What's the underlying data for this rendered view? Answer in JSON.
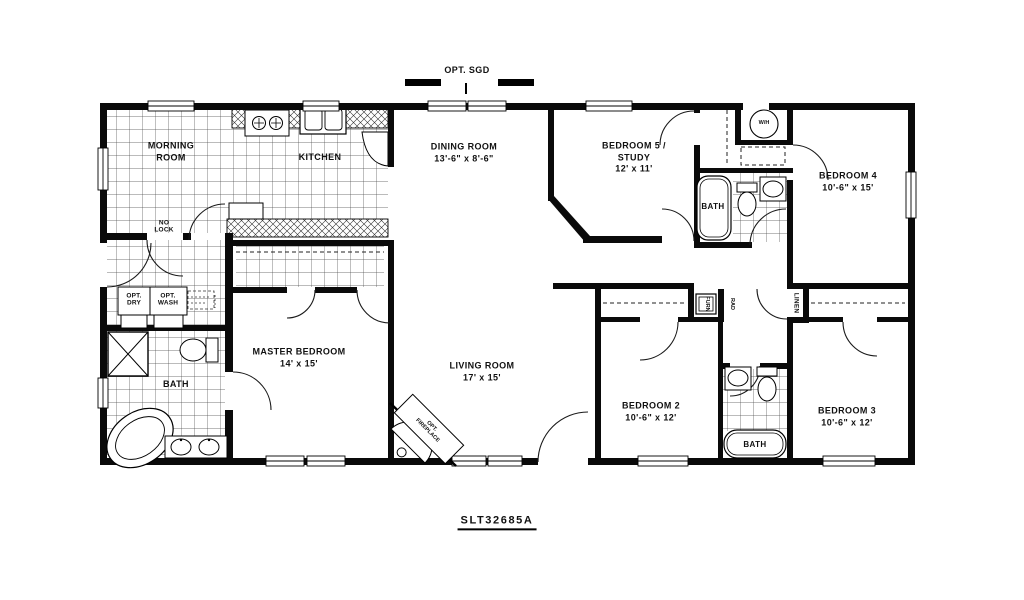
{
  "plan": {
    "model": "SLT32685A",
    "top_option": "OPT. SGD",
    "rooms": {
      "morning": {
        "l1": "MORNING",
        "l2": "ROOM"
      },
      "kitchen": {
        "l1": "KITCHEN"
      },
      "dining": {
        "l1": "DINING ROOM",
        "dims": "13'-6\" x 8'-6\""
      },
      "bed5": {
        "l1": "BEDROOM 5 /",
        "l2": "STUDY",
        "dims": "12' x 11'"
      },
      "bed4": {
        "l1": "BEDROOM 4",
        "dims": "10'-6\" x 15'"
      },
      "master": {
        "l1": "MASTER BEDROOM",
        "dims": "14' x 15'"
      },
      "living": {
        "l1": "LIVING ROOM",
        "dims": "17' x 15'"
      },
      "bed2": {
        "l1": "BEDROOM 2",
        "dims": "10'-6\" x 12'"
      },
      "bed3": {
        "l1": "BEDROOM 3",
        "dims": "10'-6\" x 12'"
      },
      "bath_master": "BATH",
      "bath_hall": "BATH",
      "bath_rear": "BATH"
    },
    "annotations": {
      "no_lock_l1": "NO",
      "no_lock_l2": "LOCK",
      "opt_dry_l1": "OPT.",
      "opt_dry_l2": "DRY",
      "opt_wash_l1": "OPT.",
      "opt_wash_l2": "WASH",
      "water_heater": "W/H",
      "linen": "LINEN",
      "furnace": "FURN",
      "rad": "RAD",
      "fireplace_l1": "OPT.",
      "fireplace_l2": "FIREPLACE"
    },
    "colors": {
      "ink": "#111111",
      "paper": "#ffffff"
    }
  }
}
